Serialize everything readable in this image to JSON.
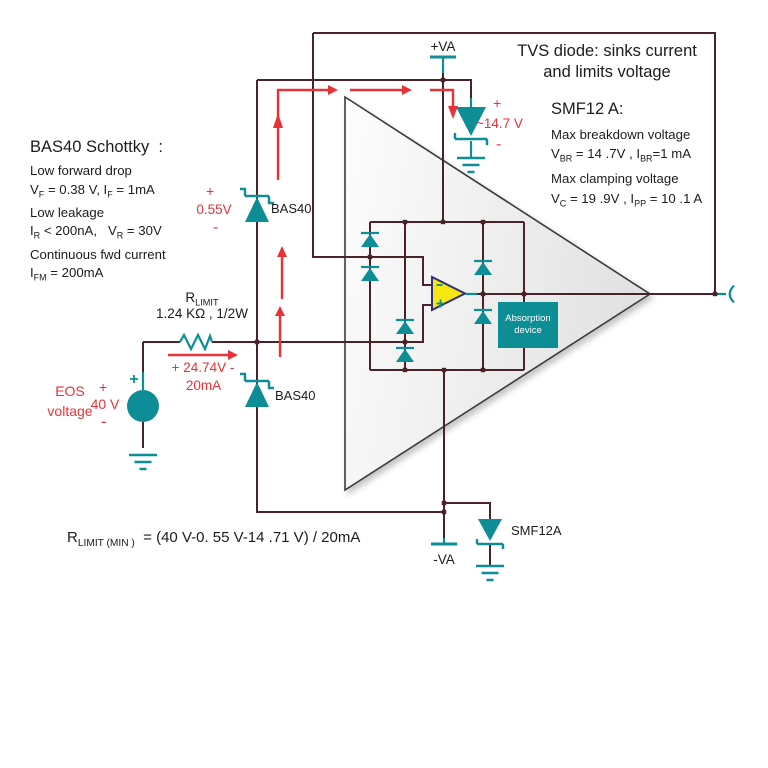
{
  "palette": {
    "wire": "#4a2228",
    "teal": "#0d8e96",
    "red": "#e93238",
    "opamp_fill": "#f7e713",
    "opamp_stroke": "#30307a",
    "absorption_fill": "#0d8d94",
    "triangle_fill": "#ededed",
    "text": "#1c1c1c"
  },
  "supplies": {
    "positive": "+VA",
    "negative": "-VA"
  },
  "bas40_note": {
    "heading": "BAS40 Schottky&nbsp; :",
    "lines": [
      "Low forward drop",
      "V<sub>F</sub> = 0.38 V, I<sub>F</sub> = 1mA",
      "Low leakage",
      "I<sub>R</sub> &lt; 200nA,&nbsp;&nbsp; V<sub>R</sub> = 30V",
      "Continuous fwd current",
      "I<sub>FM</sub> = 200mA"
    ]
  },
  "tvs_note": {
    "title_line1": "TVS diode: sinks current",
    "title_line2": "and limits voltage",
    "part": "SMF12 A:",
    "lines": [
      "Max breakdown voltage",
      "V<sub>BR</sub> = 14 .7V , I<sub>BR</sub>=1 mA",
      "Max clamping voltage",
      "V<sub>C</sub> = 19 .9V , I<sub>PP</sub> = 10 .1 A"
    ]
  },
  "resistor": {
    "name": "R<sub>LIMIT</sub>",
    "value": "1.24 KΩ , 1/2W",
    "drop_label": "+ 24.74V -",
    "current_label": "20mA"
  },
  "source": {
    "name_line1": "EOS",
    "name_line2": "voltage",
    "plus": "+",
    "value": "40 V",
    "minus": "-",
    "terminal_plus": "+"
  },
  "diodes": {
    "upper_label": "BAS40",
    "lower_label": "BAS40",
    "bottom_label": "SMF12A",
    "upper_drop": {
      "plus": "+",
      "value": "0.55V",
      "minus": "-"
    },
    "tvs_drop": {
      "plus": "+",
      "value": "~14.7 V",
      "minus": "-"
    }
  },
  "opamp": {
    "minus": "-",
    "plus": "+"
  },
  "absorption": {
    "line1": "Absorption",
    "line2": "device"
  },
  "formula": "R<sub>LIMIT (MIN )</sub>&nbsp; = (40 V-0. 55 V-14 .71 V) / 20mA"
}
